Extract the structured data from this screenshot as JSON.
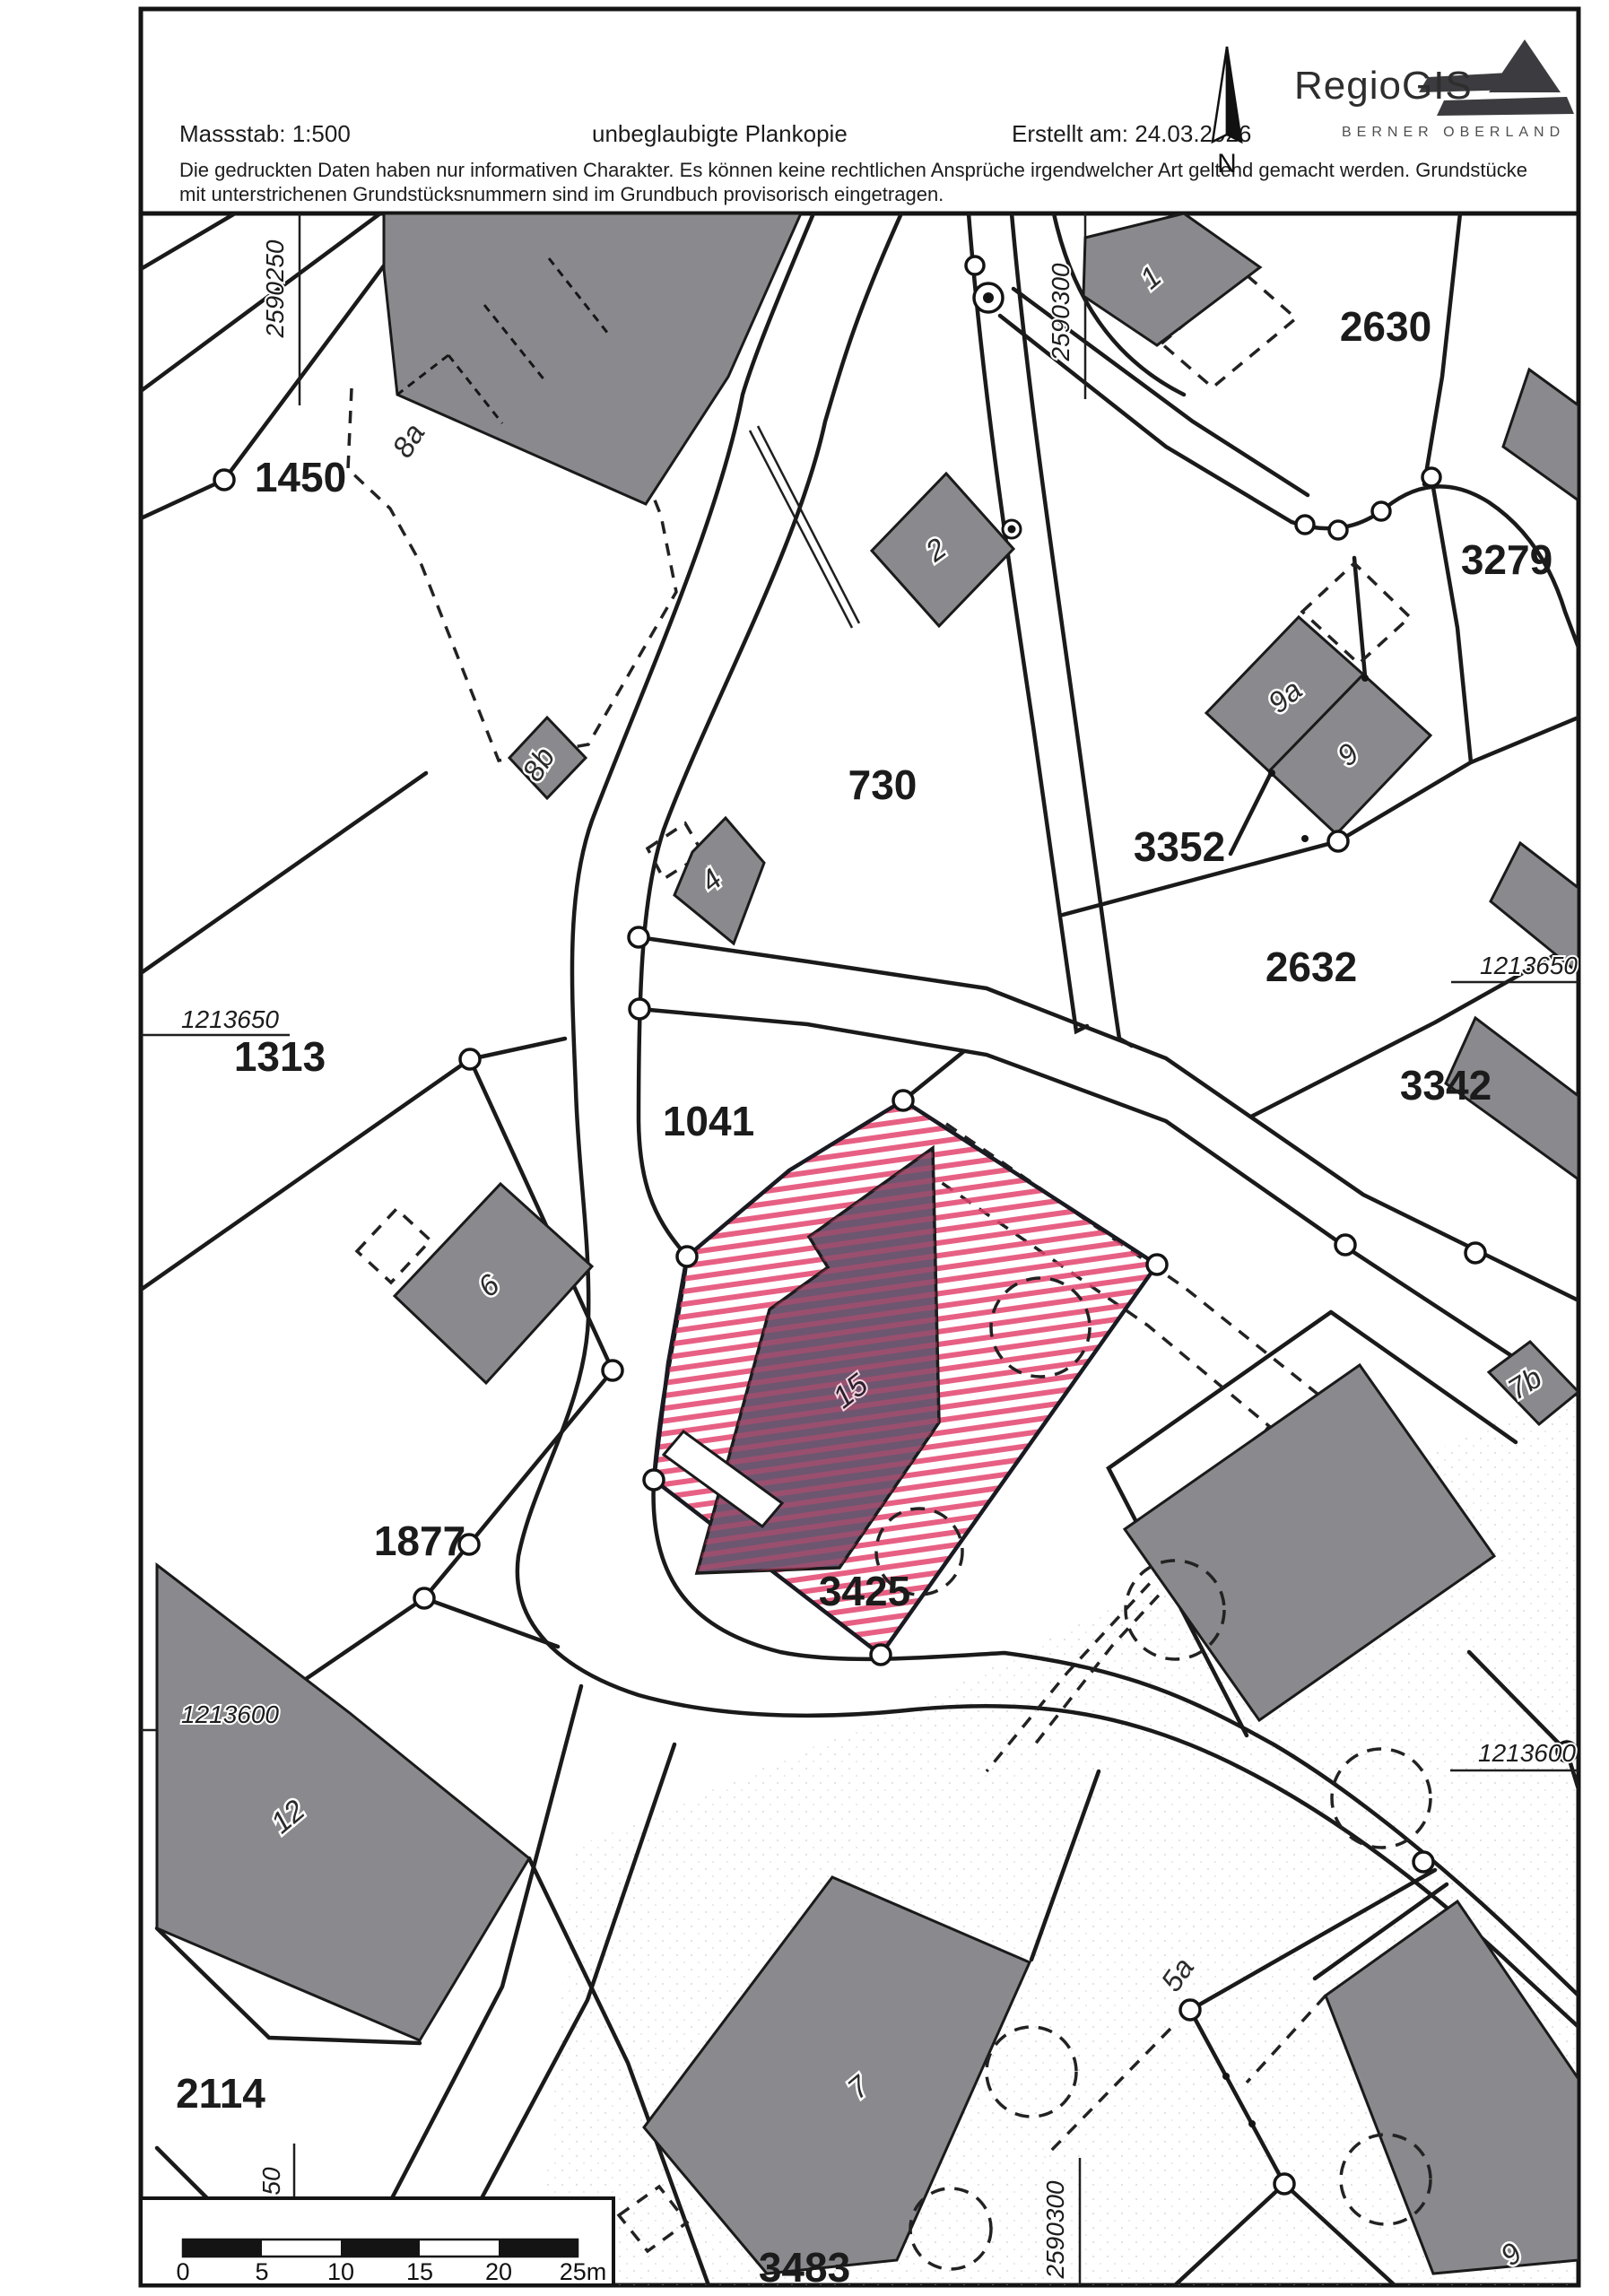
{
  "document": {
    "scale_label": "Massstab: 1:500",
    "copy_type": "unbeglaubigte Plankopie",
    "created_label": "Erstellt am: 24.03.2026",
    "disclaimer_line1": "Die gedruckten Daten haben nur informativen Charakter. Es können keine rechtlichen Ansprüche irgendwelcher Art geltend gemacht werden. Grundstücke",
    "disclaimer_line2": "mit unterstrichenen Grundstücksnummern sind im Grundbuch provisorisch eingetragen.",
    "north_label": "N"
  },
  "logo": {
    "name": "RegioGIS",
    "subtitle": "BERNER OBERLAND"
  },
  "map": {
    "highlighted_parcel": {
      "number": "3425",
      "building_number": "15"
    },
    "parcel_labels": [
      {
        "number": "1450"
      },
      {
        "number": "2630"
      },
      {
        "number": "3279"
      },
      {
        "number": "730"
      },
      {
        "number": "3352"
      },
      {
        "number": "2632"
      },
      {
        "number": "1313"
      },
      {
        "number": "1041"
      },
      {
        "number": "3342"
      },
      {
        "number": "1877"
      },
      {
        "number": "3425"
      },
      {
        "number": "2114"
      },
      {
        "number": "3483"
      }
    ],
    "building_labels": [
      "8a",
      "8b",
      "2",
      "1",
      "9a",
      "9",
      "4",
      "6",
      "7b",
      "15",
      "12",
      "7",
      "5a",
      "9"
    ],
    "coordinates": {
      "easting_top_left": "2590250",
      "easting_top_right": "2590300",
      "northing_left_upper": "1213650",
      "northing_right_upper": "1213650",
      "northing_left_lower": "1213600",
      "northing_right_lower": "1213600",
      "easting_bottom": "2590300",
      "easting_bottom_left_partial": "50"
    },
    "scale_bar": {
      "tick_labels": [
        "0",
        "5",
        "10",
        "15",
        "20",
        "25m"
      ]
    }
  },
  "colors": {
    "building_gray": "#8a8a8e",
    "line_black": "#1a1a1a",
    "hatch_pink": "#e3446e",
    "highlight_building": "#6d5670"
  }
}
